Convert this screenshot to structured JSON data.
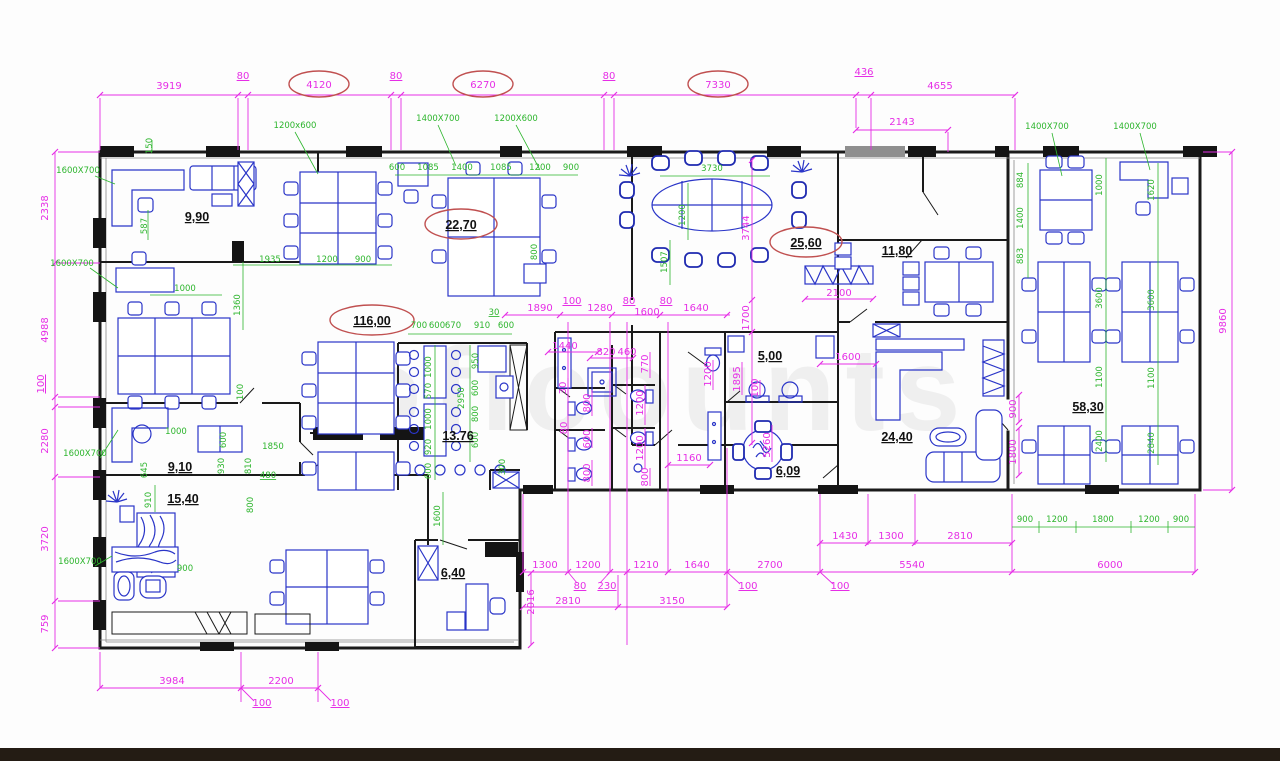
{
  "watermark": "oficounts",
  "rooms": [
    {
      "label": "9,90"
    },
    {
      "label": "22,70"
    },
    {
      "label": "25,60"
    },
    {
      "label": "11,80"
    },
    {
      "label": "116,00"
    },
    {
      "label": "13.76"
    },
    {
      "label": "9,10"
    },
    {
      "label": "15,40"
    },
    {
      "label": "6,40"
    },
    {
      "label": "5,00"
    },
    {
      "label": "6,09"
    },
    {
      "label": "24,40"
    },
    {
      "label": "58,30"
    }
  ],
  "dim": {
    "top": [
      "3919",
      "80",
      "4120",
      "80",
      "6270",
      "80",
      "7330",
      "436",
      "4655",
      "2143"
    ],
    "left": [
      "2338",
      "4988",
      "100",
      "2280",
      "3720",
      "759"
    ],
    "right": [
      "9860"
    ],
    "bottom": [
      "1300",
      "1200",
      "80",
      "230",
      "1210",
      "1640",
      "100",
      "2700",
      "100",
      "1430",
      "1300",
      "2810",
      "5540",
      "6000",
      "2810",
      "3150",
      "2016",
      "3984",
      "2200",
      "100",
      "100"
    ],
    "wc_top": [
      "1890",
      "100",
      "1280",
      "80",
      "1600",
      "80",
      "1640",
      "1700"
    ],
    "wc_inner": [
      "1440",
      "820",
      "460",
      "770",
      "30",
      "800",
      "80",
      "600",
      "800",
      "1200",
      "1200",
      "800",
      "1160",
      "1200",
      "1895",
      "100",
      "5260"
    ],
    "east": [
      "2100",
      "1600",
      "900",
      "1800",
      "3744"
    ]
  },
  "green": {
    "topleft": [
      "150",
      "587",
      "1935",
      "1200",
      "900",
      "1000",
      "1360"
    ],
    "row22": [
      "600",
      "1085",
      "1400",
      "1085",
      "1200",
      "900",
      "800"
    ],
    "conf": [
      "3730",
      "1200",
      "1507"
    ],
    "kitchen_top": [
      "700",
      "600",
      "670",
      "910",
      "600",
      "30"
    ],
    "kitchen_v1": [
      "1000",
      "570",
      "1000",
      "920",
      "600"
    ],
    "kitchen_v2": [
      "950",
      "600",
      "800",
      "600",
      "2950"
    ],
    "kitchen_misc": [
      "300",
      "1600"
    ],
    "rooms_sw": [
      "645",
      "910",
      "1000",
      "600",
      "930",
      "1850",
      "810",
      "480",
      "800",
      "900",
      "100"
    ],
    "wing_c1": [
      "884",
      "1400",
      "883"
    ],
    "wing_c2": [
      "1000",
      "3600",
      "1100",
      "2400"
    ],
    "wing_c3": [
      "1620",
      "3600",
      "1100",
      "2840"
    ],
    "wing_bottom": [
      "900",
      "1200",
      "1800",
      "1200",
      "900"
    ]
  },
  "sizes": [
    "1200x600",
    "1400X700",
    "1200X600",
    "1600X700",
    "1600X700",
    "1600X700",
    "1600X700",
    "1400X700",
    "1400X700"
  ]
}
